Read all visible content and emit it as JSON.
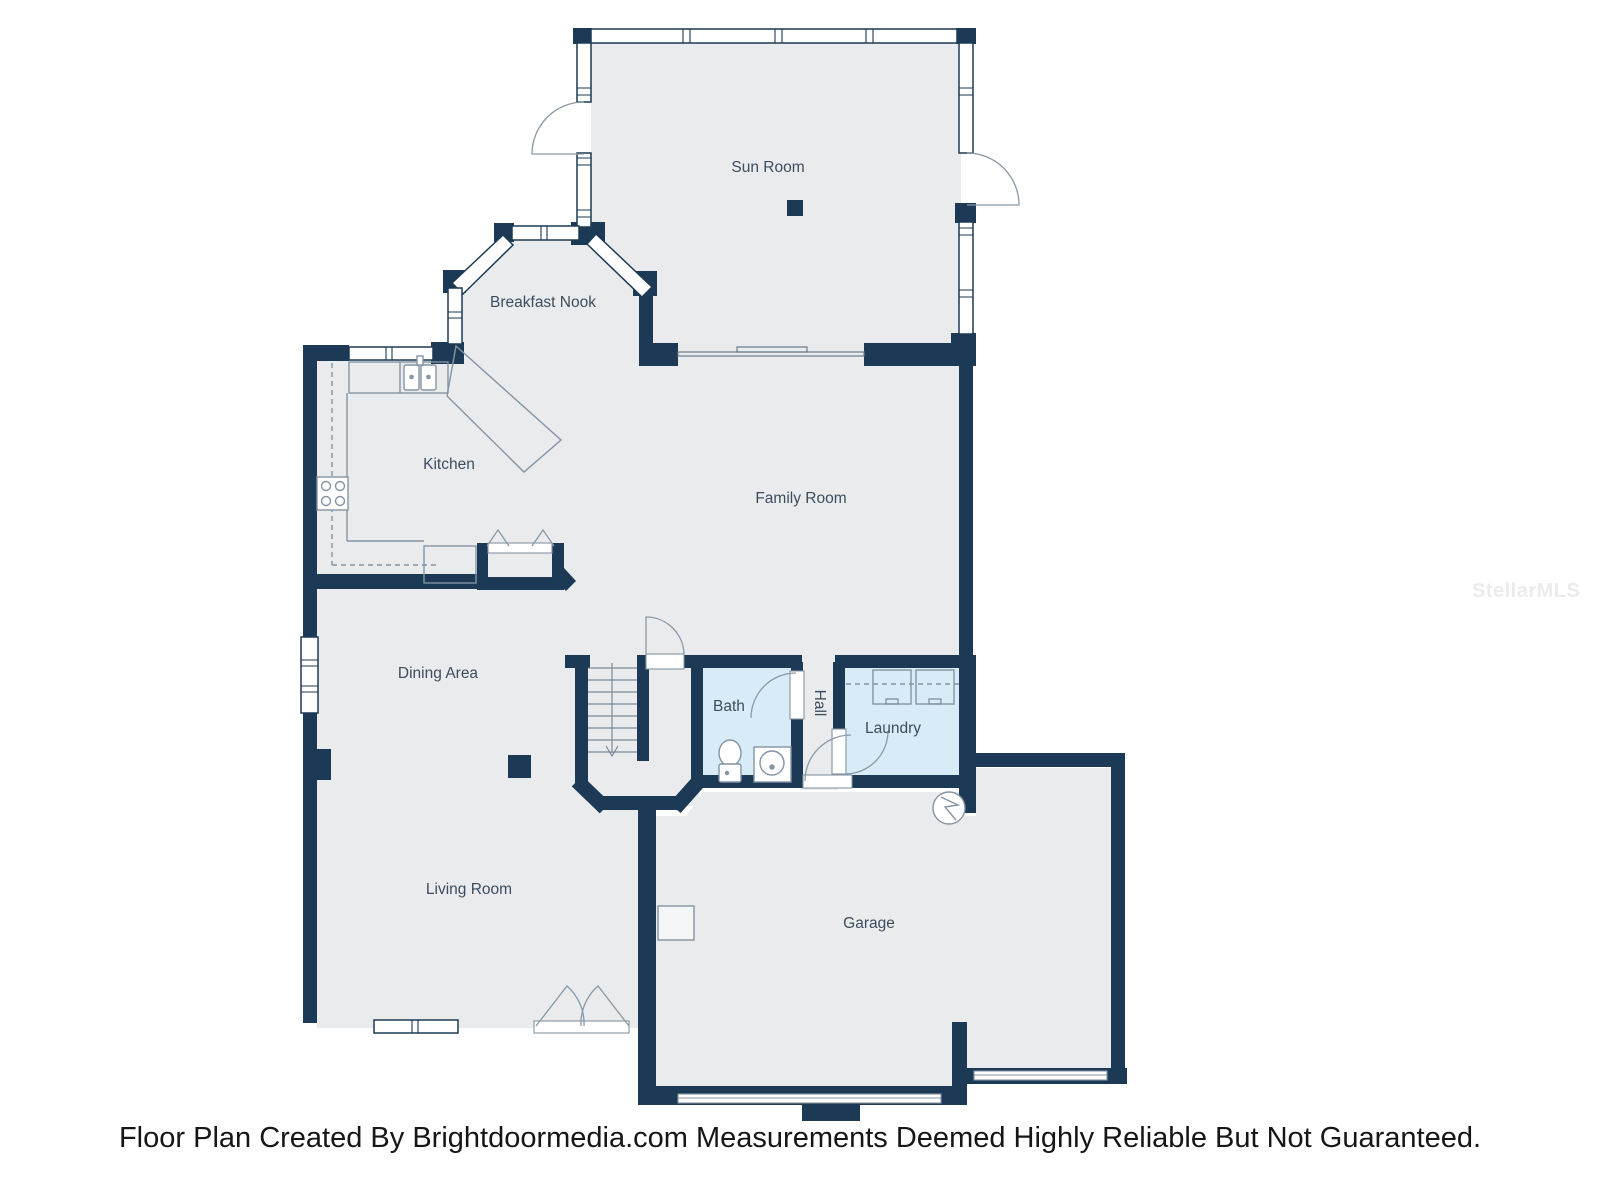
{
  "floor_plan": {
    "rooms": {
      "sun_room": "Sun Room",
      "breakfast_nook": "Breakfast Nook",
      "kitchen": "Kitchen",
      "family_room": "Family Room",
      "dining_area": "Dining Area",
      "bath": "Bath",
      "hall": "Hall",
      "laundry": "Laundry",
      "living_room": "Living Room",
      "garage": "Garage"
    },
    "colors": {
      "wall": "#1c3a55",
      "floor": "#e9ebed",
      "wet_room_floor": "#d7ecf7",
      "fixture_line": "#8494a3",
      "label_text": "#3d4d5e"
    }
  },
  "watermark": "StellarMLS",
  "caption": "Floor Plan Created By Brightdoormedia.com Measurements Deemed Highly Reliable But Not Guaranteed."
}
